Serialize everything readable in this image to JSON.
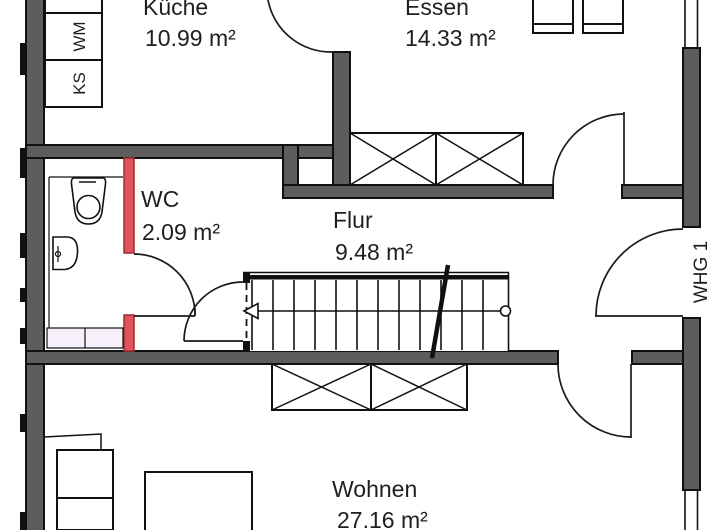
{
  "plan": {
    "rooms": [
      {
        "id": "kueche",
        "name": "Küche",
        "area": "10.99 m²"
      },
      {
        "id": "essen",
        "name": "Essen",
        "area": "14.33 m²"
      },
      {
        "id": "wc",
        "name": "WC",
        "area": "2.09 m²"
      },
      {
        "id": "flur",
        "name": "Flur",
        "area": "9.48 m²"
      },
      {
        "id": "wohnen",
        "name": "Wohnen",
        "area": "27.16 m²"
      }
    ],
    "appliances": [
      {
        "label": "WM"
      },
      {
        "label": "KS"
      }
    ],
    "unit_label": "WHG 1",
    "colors": {
      "wall": "#5d5d5d",
      "new_wall_red": "#e25359",
      "outline": "#111111",
      "background": "#ffffff",
      "vanity_fill": "#f6f0fa"
    }
  }
}
